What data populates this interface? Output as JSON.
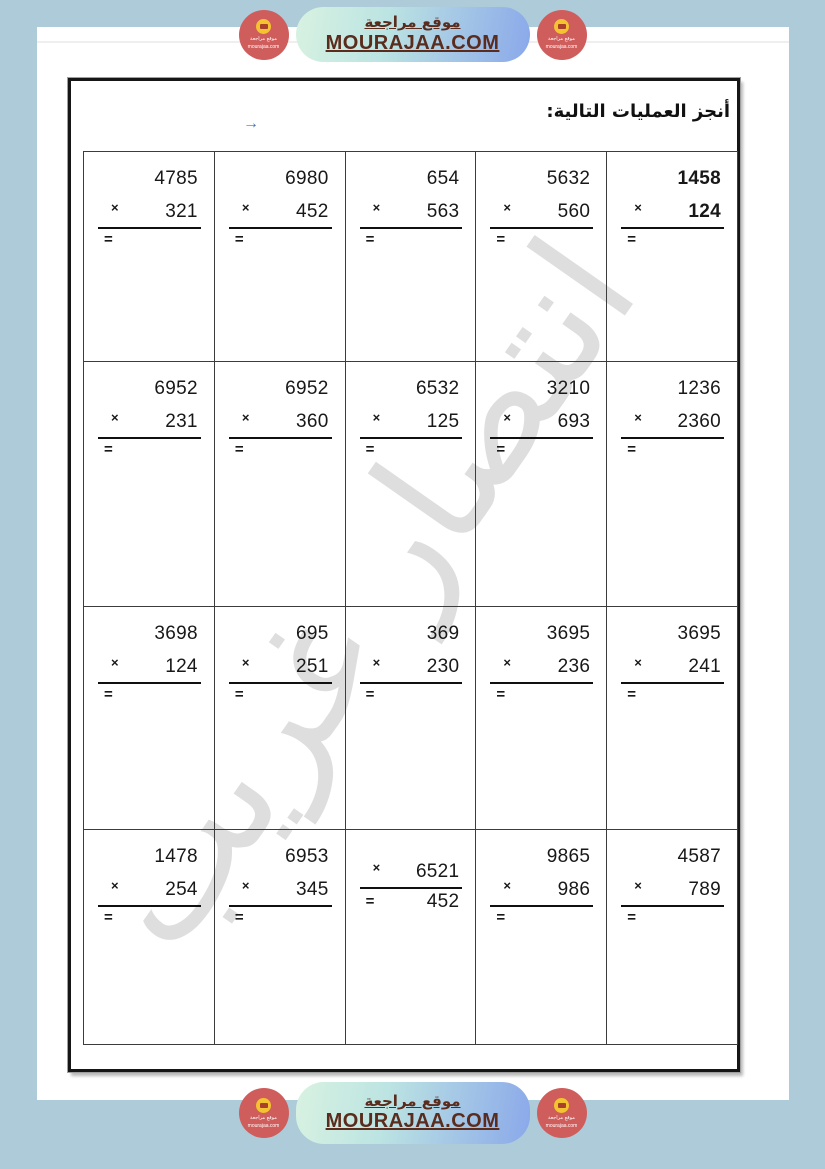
{
  "banner": {
    "site_title_ar": "موقع مراجعة",
    "site_domain": "MOURAJAA.COM",
    "logo": {
      "line1": "موقع مراجعة",
      "line2": "mourajaa.com"
    }
  },
  "worksheet": {
    "title": "أنجز العمليات التالية:",
    "watermark": "انتصار غريب",
    "symbols": {
      "times": "×",
      "equals": "=",
      "arrow": "→"
    },
    "rows": [
      [
        {
          "a": "1458",
          "b": "124",
          "bold": true
        },
        {
          "a": "5632",
          "b": "560"
        },
        {
          "a": "654",
          "b": "563"
        },
        {
          "a": "6980",
          "b": "452"
        },
        {
          "a": "4785",
          "b": "321"
        }
      ],
      [
        {
          "a": "1236",
          "b": "2360"
        },
        {
          "a": "3210",
          "b": "693"
        },
        {
          "a": "6532",
          "b": "125"
        },
        {
          "a": "6952",
          "b": "360"
        },
        {
          "a": "6952",
          "b": "231"
        }
      ],
      [
        {
          "a": "3695",
          "b": "241"
        },
        {
          "a": "3695",
          "b": "236"
        },
        {
          "a": "369",
          "b": "230"
        },
        {
          "a": "695",
          "b": "251"
        },
        {
          "a": "3698",
          "b": "124"
        }
      ],
      [
        {
          "a": "4587",
          "b": "789"
        },
        {
          "a": "9865",
          "b": "986"
        },
        {
          "a": "6521",
          "b": "452",
          "layout": "inline"
        },
        {
          "a": "6953",
          "b": "345"
        },
        {
          "a": "1478",
          "b": "254"
        }
      ]
    ]
  },
  "colors": {
    "page_background": "#adcbd9",
    "paper": "#ffffff",
    "pill_gradient_left": "#d8f2e1",
    "pill_gradient_right": "#8aa8ea",
    "banner_text": "#5a2c1d",
    "logo_circle": "#cf5d5b",
    "logo_badge": "#f3c331",
    "arrow_blue": "#4472c4",
    "watermark_gray": "#dedede",
    "frame_border": "#161616"
  }
}
